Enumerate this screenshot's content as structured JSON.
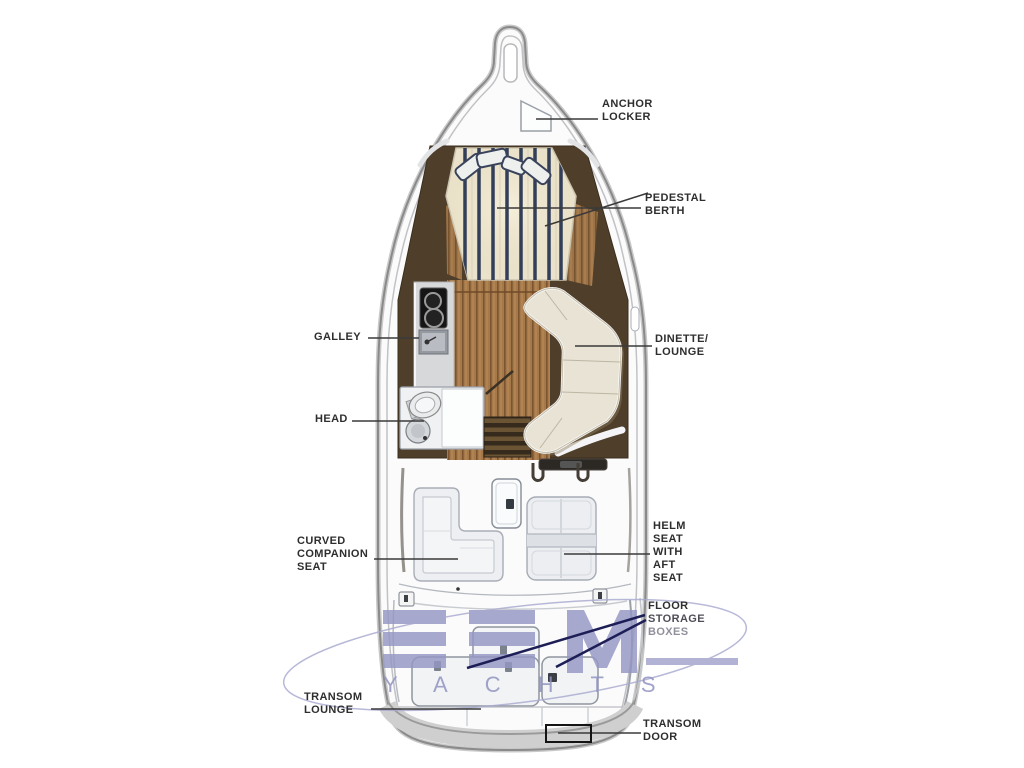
{
  "page": {
    "type": "boat-deck-plan-diagram"
  },
  "palette": {
    "cabin_brown": "#4e3e2a",
    "wood_light": "#a5794a",
    "wood_dark": "#7c5530",
    "berth_cream": "#eae2cb",
    "stripe_navy": "#333e59",
    "sofa_cream": "#e8e3d5",
    "seat_gray": "#edeff2",
    "leader_gray": "#3a3a3a",
    "leader_navy": "#1d1e56",
    "watermark_purple": "#9597c4",
    "label_text": "#2e2e2e"
  },
  "labels": {
    "anchor_locker": {
      "l1": "ANCHOR",
      "l2": "LOCKER"
    },
    "pedestal_berth": {
      "l1": "PEDESTAL",
      "l2": "BERTH"
    },
    "galley": {
      "l1": "GALLEY"
    },
    "head": {
      "l1": "HEAD"
    },
    "dinette_lounge": {
      "l1": "DINETTE/",
      "l2": "LOUNGE"
    },
    "curved_companion_seat": {
      "l1": "CURVED",
      "l2": "COMPANION",
      "l3": "SEAT"
    },
    "helm_seat": {
      "l1": "HELM",
      "l2": "SEAT",
      "l3": "WITH",
      "l4": "AFT",
      "l5": "SEAT"
    },
    "floor_storage_boxes": {
      "l1": "FLOOR",
      "l2": "STORAGE",
      "l3": "BOXES"
    },
    "transom_lounge": {
      "l1": "TRANSOM",
      "l2": "LOUNGE"
    },
    "transom_door": {
      "l1": "TRANSOM",
      "l2": "DOOR"
    }
  },
  "watermark": {
    "brand": "EFM",
    "sub": "YACHTS"
  }
}
